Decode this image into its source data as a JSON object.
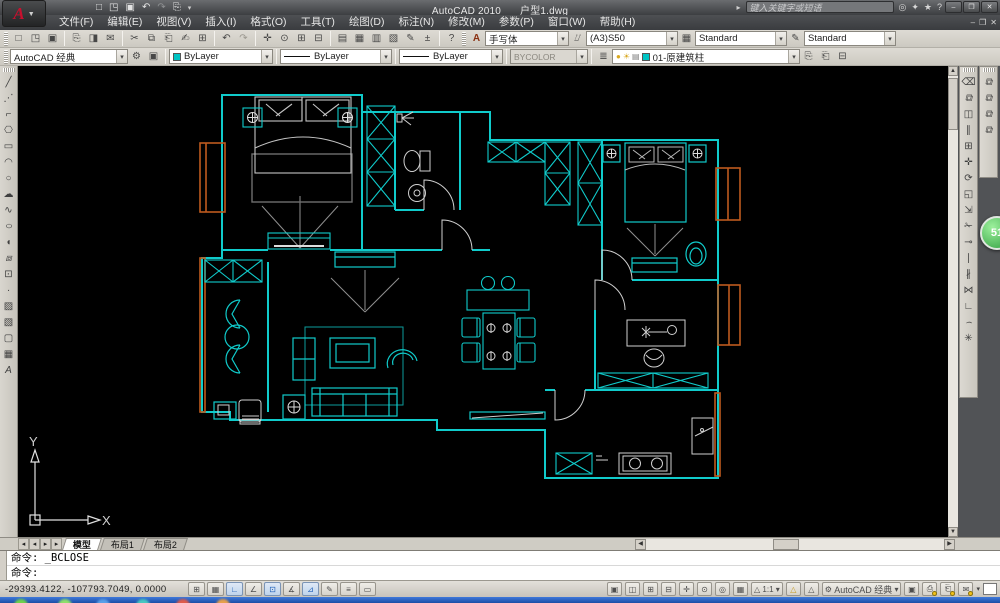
{
  "title_bar": {
    "logo_letter": "A",
    "app_title": "AutoCAD 2010",
    "doc_title": "户型1.dwg",
    "search_placeholder": "键入关键字或短语",
    "window_controls": {
      "minimize": "‒",
      "restore": "❐",
      "close": "✕"
    },
    "qat": {
      "new": "□",
      "open": "◳",
      "save": "▣",
      "undo": "↶",
      "redo": "↷",
      "plot": "⎘",
      "dropdown": "▾"
    },
    "infocenter": {
      "toggle": "▸",
      "search": "◎",
      "subscription": "✦",
      "favorites": "★",
      "help": "?"
    }
  },
  "menu_bar": {
    "items": [
      "文件(F)",
      "编辑(E)",
      "视图(V)",
      "插入(I)",
      "格式(O)",
      "工具(T)",
      "绘图(D)",
      "标注(N)",
      "修改(M)",
      "参数(P)",
      "窗口(W)",
      "帮助(H)"
    ],
    "doc_controls": [
      "‒",
      "❐",
      "✕"
    ]
  },
  "toolbars": {
    "standard": [
      "□",
      "◳",
      "▣",
      "⎘",
      "◨",
      "✉",
      "✂",
      "⧉",
      "⎗",
      "✍",
      "⊞",
      "↶",
      "↷",
      "✛",
      "⊙",
      "⊞",
      "⊟",
      "▤",
      "▦",
      "▥",
      "▧",
      "✎",
      "±",
      "?"
    ],
    "styles": {
      "text_style_icon": "A",
      "text_style": "手写体",
      "dim_style": "(A3)S50",
      "table_style": "Standard",
      "mleader_style": "Standard"
    },
    "workspace": {
      "value": "AutoCAD 经典"
    },
    "properties": {
      "color": "ByLayer",
      "linetype": "ByLayer",
      "lineweight": "ByLayer",
      "plot_style": "BYCOLOR"
    },
    "layers": {
      "bulb": "●",
      "sun": "☀",
      "plot": "▤",
      "current": "01-原建筑柱"
    },
    "draw": [
      "╱",
      "⋰",
      "⌐",
      "⎔",
      "▭",
      "◠",
      "○",
      "☁",
      "∿",
      "○",
      "◖",
      "⧈",
      "⊡",
      "·",
      "▨",
      "▧",
      "▢",
      "▦",
      "A"
    ],
    "modify": [
      "⌫",
      "⧉",
      "◫",
      "∥",
      "⊞",
      "✛",
      "⟳",
      "◱",
      "⇲",
      "✁",
      "⊸",
      "∣",
      "∦",
      "⋈",
      "∟",
      "⌢",
      "✳"
    ],
    "draworder": [
      "⧉",
      "⧉",
      "⧉",
      "⧉"
    ]
  },
  "layout_tabs": {
    "nav": [
      "◂",
      "◂",
      "▸",
      "▸"
    ],
    "tabs": [
      "模型",
      "布局1",
      "布局2"
    ],
    "active": "模型"
  },
  "command_line": {
    "history": "命令: _BCLOSE",
    "prompt": "命令:"
  },
  "status_bar": {
    "coordinates": "-29393.4122, -107793.7049,  0.0000",
    "toggles": [
      "⊞",
      "▦",
      "∟",
      "∠",
      "⊡",
      "∡",
      "⊿",
      "✎",
      "≡",
      "▭"
    ],
    "right": {
      "model": "▣",
      "layout": "◫",
      "qv_drawings": "⊞",
      "qv_layouts": "⊟",
      "pan": "✛",
      "zoom": "⊙",
      "wheel": "◎",
      "motion": "▦",
      "annot": "△",
      "scale": "1:1",
      "dropdown": "▾",
      "visibility": "△",
      "auto": "△",
      "gear": "⚙",
      "workspace": "AutoCAD 经典",
      "lock": "▣",
      "tray": [
        "⎙",
        "⎗",
        "✉"
      ],
      "clean": " "
    }
  },
  "ucs": {
    "x_label": "X",
    "y_label": "Y"
  },
  "overlay": {
    "badge": "51"
  },
  "colors": {
    "wall_cyan": "#10cbcb",
    "window_orange": "#be5a1e",
    "furniture_white": "#c9c9c9",
    "canvas": "#000000"
  }
}
